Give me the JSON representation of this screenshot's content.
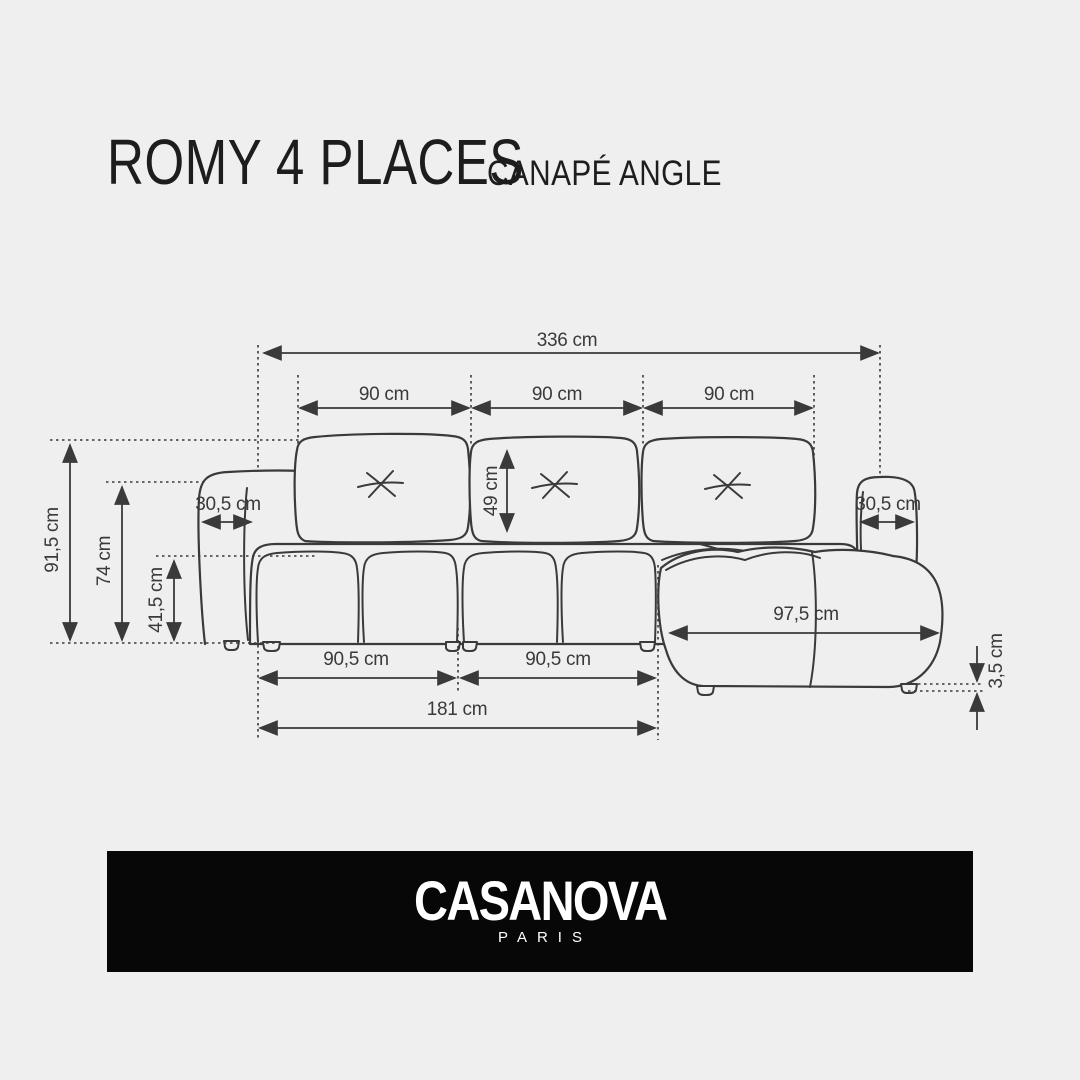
{
  "title": {
    "main": "ROMY 4 PLACES",
    "subtitle": "CANAPÉ ANGLE"
  },
  "diagram": {
    "labels": {
      "total_width": "336 cm",
      "seat1_width": "90 cm",
      "seat2_width": "90 cm",
      "seat3_width": "90 cm",
      "total_height": "91,5 cm",
      "armrest_height": "74 cm",
      "seat_height": "41,5 cm",
      "left_armrest_width": "30,5 cm",
      "back_cushion_height": "49 cm",
      "right_armrest_width": "30,5 cm",
      "chaise_length": "97,5 cm",
      "module1_width": "90,5 cm",
      "module2_width": "90,5 cm",
      "double_module_width": "181 cm",
      "foot_height": "3,5 cm"
    }
  },
  "footer": {
    "brand": "CASANOVA",
    "city": "PARIS"
  },
  "colors": {
    "background": "#efefef",
    "line": "#3a3a3a",
    "banner_background": "#070707",
    "banner_text": "#ffffff"
  }
}
